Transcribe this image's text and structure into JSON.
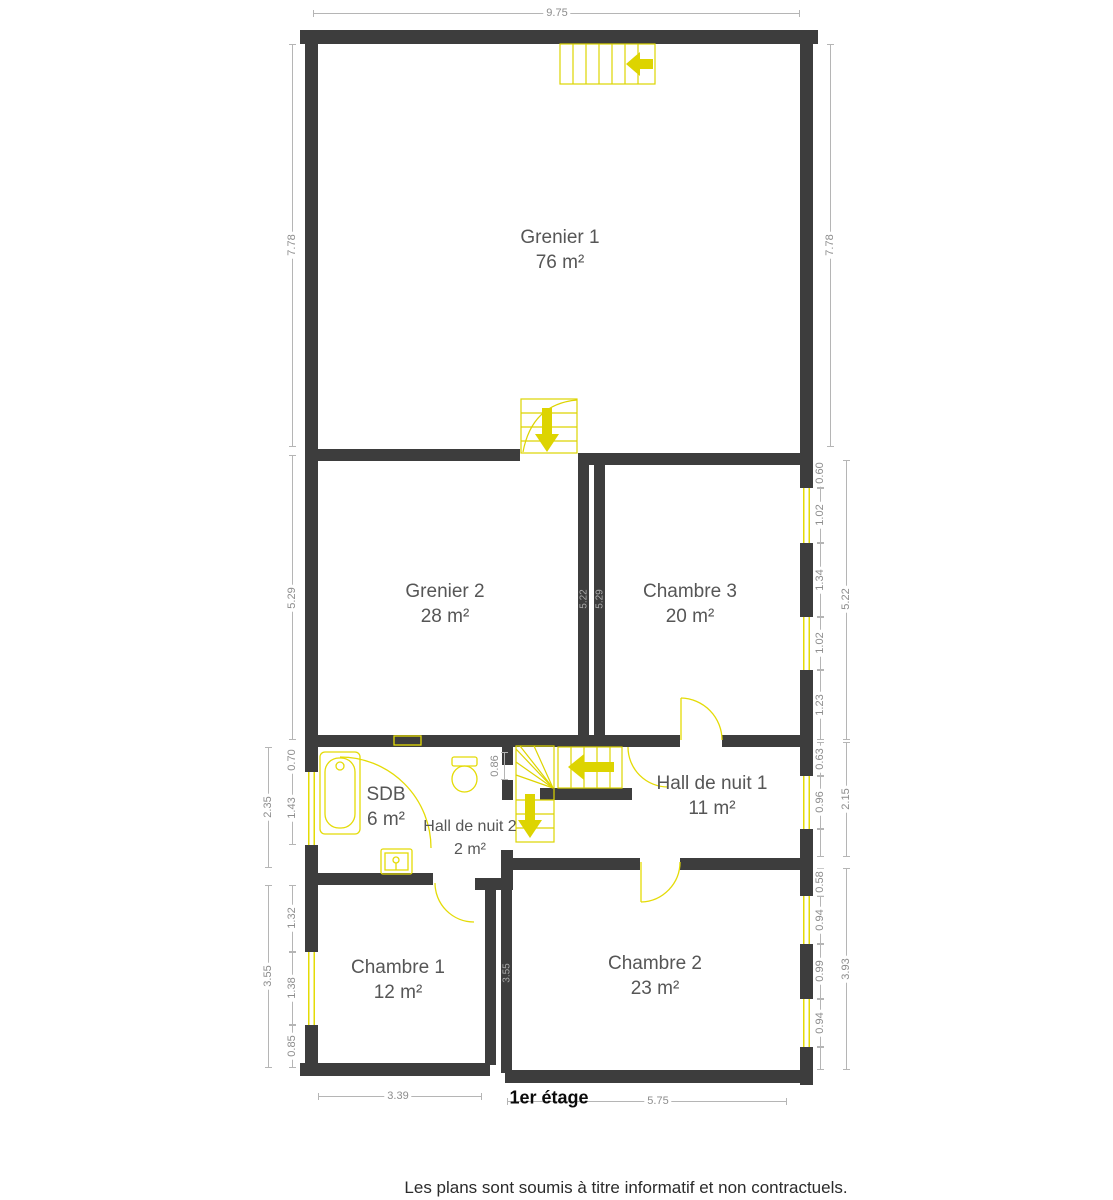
{
  "plan": {
    "title": "1er étage",
    "disclaimer": "Les plans sont soumis à titre informatif et non contractuels.",
    "rooms": [
      {
        "name": "Grenier 1",
        "area": "76 m²"
      },
      {
        "name": "Grenier 2",
        "area": "28 m²"
      },
      {
        "name": "Chambre 3",
        "area": "20 m²"
      },
      {
        "name": "SDB",
        "area": "6 m²"
      },
      {
        "name": "Hall de nuit 2",
        "area": "2 m²"
      },
      {
        "name": "Hall de nuit 1",
        "area": "11 m²"
      },
      {
        "name": "Chambre 1",
        "area": "12 m²"
      },
      {
        "name": "Chambre 2",
        "area": "23 m²"
      }
    ],
    "dimensions": {
      "top_width": "9.75",
      "grenier1_left": "7.78",
      "grenier1_right": "7.78",
      "grenier2_left": "5.29",
      "chambre3_right": [
        "0.60",
        "1.02",
        "1.34",
        "1.02",
        "1.23"
      ],
      "chambre3_right_total": "5.22",
      "hall1_right": [
        "0.63",
        "0.96"
      ],
      "hall1_right_total": "2.15",
      "chambre2_right": [
        "0.58",
        "0.94",
        "0.99",
        "0.94"
      ],
      "chambre2_right_total": "3.93",
      "sdb_left": [
        "0.70",
        "1.43"
      ],
      "sdb_left_total": "2.35",
      "chambre1_left": [
        "1.32",
        "1.38",
        "0.85"
      ],
      "chambre1_left_total": "3.55",
      "divider_grenier_left": "5.22",
      "divider_grenier_right": "5.29",
      "divider_chambre": "3.55",
      "wc_opening": "0.86",
      "chambre1_bottom": "3.39",
      "chambre2_bottom": "5.75"
    },
    "colors": {
      "wall": "#3d3d3d",
      "fixture": "#ddd400",
      "dim_line": "#b5b5b5",
      "dim_text": "#8d8d8d"
    }
  }
}
